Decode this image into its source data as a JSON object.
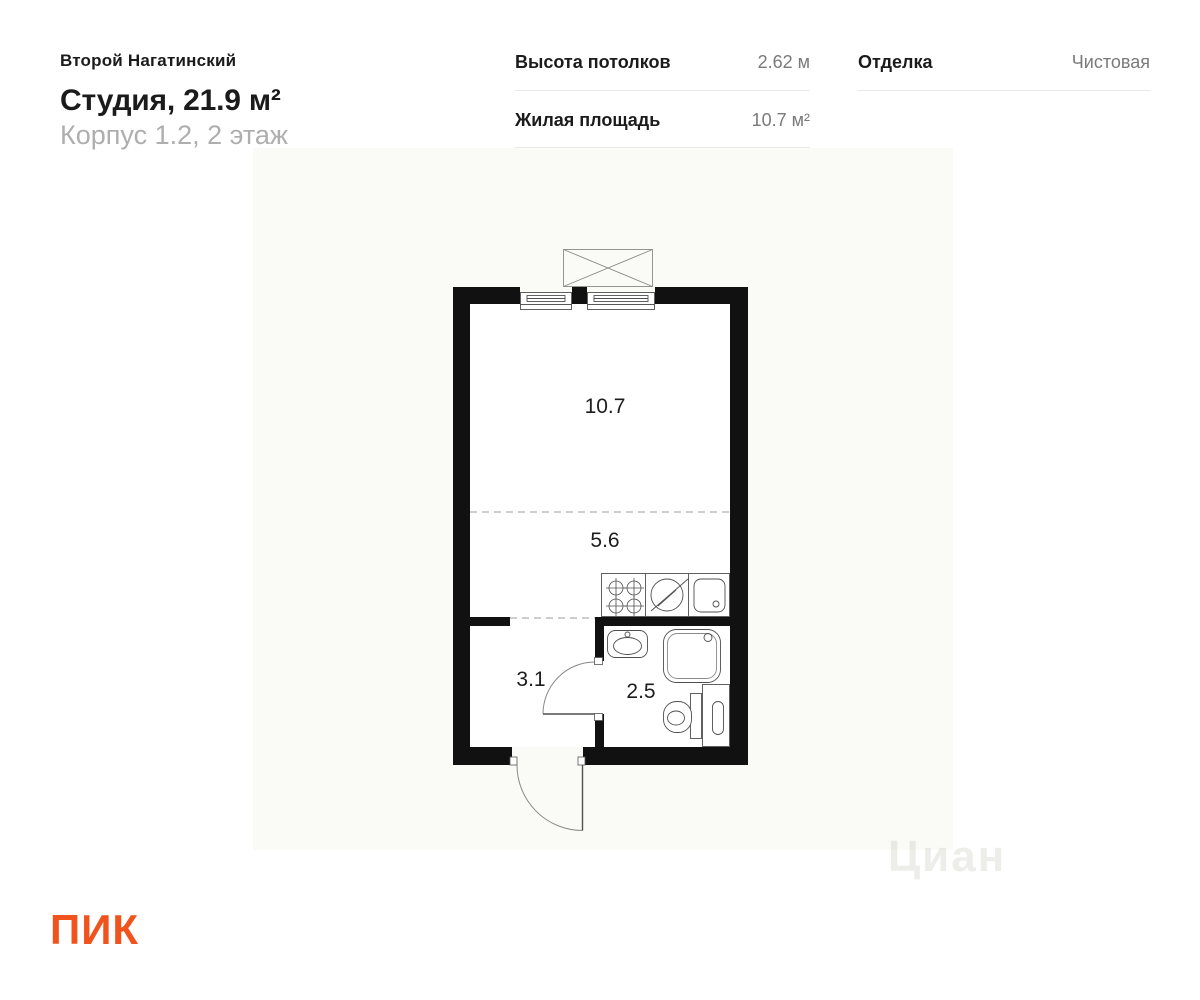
{
  "header": {
    "project_name": "Второй Нагатинский",
    "apartment_title": "Студия, 21.9 м²",
    "apartment_subtitle": "Корпус 1.2, 2 этаж",
    "specs": [
      {
        "label": "Высота потолков",
        "value": "2.62 м"
      },
      {
        "label": "Жилая площадь",
        "value": "10.7 м²"
      },
      {
        "label": "Отделка",
        "value": "Чистовая"
      }
    ]
  },
  "floor_plan": {
    "rooms": [
      {
        "name": "living-area",
        "area_label": "10.7"
      },
      {
        "name": "kitchen-zone",
        "area_label": "5.6"
      },
      {
        "name": "hallway",
        "area_label": "3.1"
      },
      {
        "name": "bathroom",
        "area_label": "2.5"
      }
    ]
  },
  "watermark_text": "Циан",
  "footer": {
    "logo_text": "ПИК"
  },
  "colors": {
    "logo_orange": "#f0541c",
    "wall_black": "#111111",
    "plan_background": "#fafaf6",
    "value_gray": "#7a7a7a",
    "subtitle_gray": "#aeaeae",
    "divider_gray": "#e9e9e6"
  }
}
